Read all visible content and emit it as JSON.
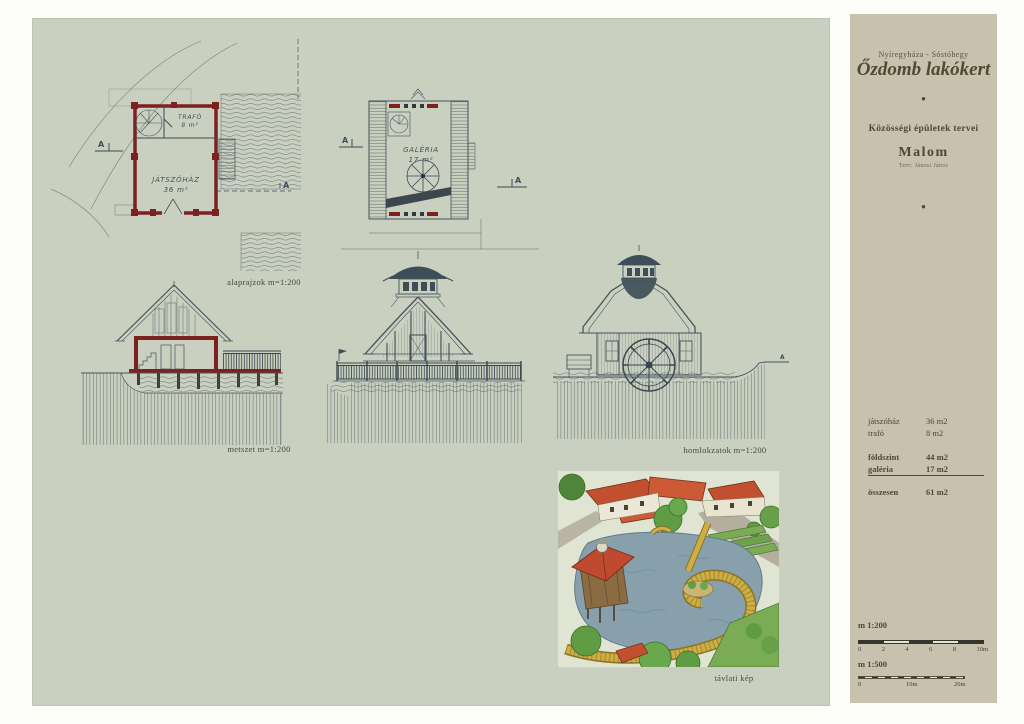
{
  "sheet": {
    "captions": {
      "plans": "alaprajzok m=1:200",
      "section": "metszet m=1:200",
      "elevations": "homlokzatok m=1:200",
      "perspective": "távlati kép"
    },
    "marker": "A",
    "plan_ground": {
      "room1_name": "TRAFÓ",
      "room1_area": "8 m²",
      "room2_name": "JÁTSZÓHÁZ",
      "room2_area": "36 m²"
    },
    "plan_gallery": {
      "room_name": "GALÉRIA",
      "room_area": "17 m²"
    }
  },
  "panel": {
    "location": "Nyíregyháza - Sóstóhegy",
    "project": "Őzdomb lakókert",
    "bullet": "●",
    "subtitle": "Közösségi épületek tervei",
    "building": "Malom",
    "architect": "Terv: Jánosi János",
    "areas": {
      "rows": [
        {
          "name": "játszóház",
          "value": "36 m2"
        },
        {
          "name": "trafó",
          "value": "8 m2"
        },
        {
          "name": "földszint",
          "value": "44 m2"
        },
        {
          "name": "galéria",
          "value": "17 m2"
        },
        {
          "name": "összesen",
          "value": "61 m2"
        }
      ]
    },
    "scalebars": [
      {
        "label": "m 1:200",
        "ticks": [
          "0",
          "2",
          "4",
          "6",
          "8",
          "10m"
        ]
      },
      {
        "label": "m 1:500",
        "ticks": [
          "0",
          "10m",
          "20m"
        ]
      }
    ]
  },
  "colors": {
    "sheet_bg": "#c9d0bf",
    "panel_bg": "#c8c1ae",
    "ink": "#44545e",
    "wall_red": "#7c2120",
    "roof_red": "#c14f30",
    "water": "#87a0ac",
    "boardwalk": "#cfae45"
  }
}
